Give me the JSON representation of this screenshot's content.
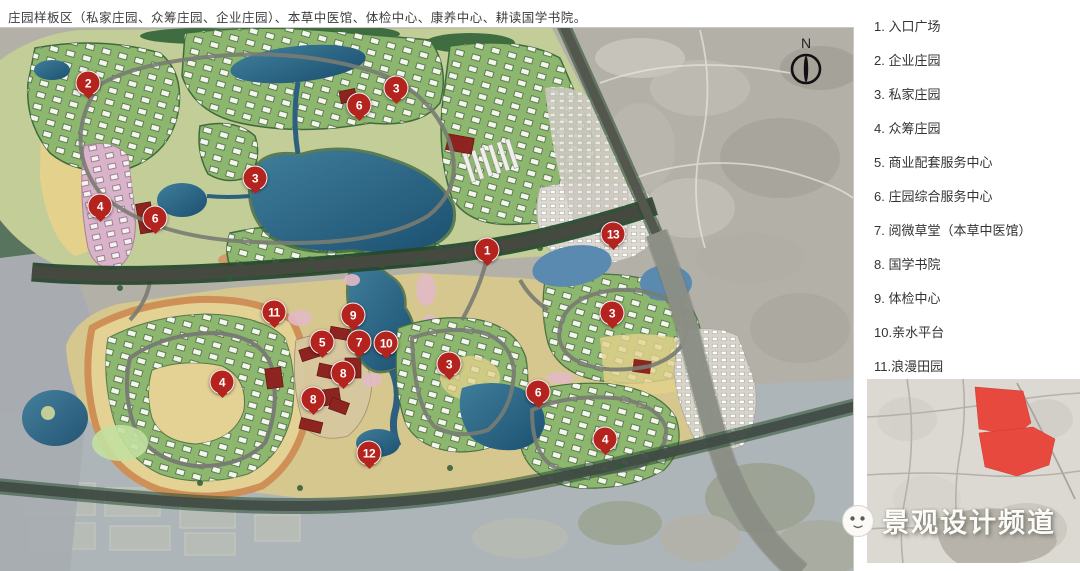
{
  "title": "庄园样板区（私家庄园、众筹庄园、企业庄园）、本草中医馆、体检中心、康养中心、耕读国学书院。",
  "legend": {
    "items": [
      {
        "num": "1",
        "label": "1. 入口广场"
      },
      {
        "num": "2",
        "label": "2. 企业庄园"
      },
      {
        "num": "3",
        "label": "3. 私家庄园"
      },
      {
        "num": "4",
        "label": "4. 众筹庄园"
      },
      {
        "num": "5",
        "label": "5. 商业配套服务中心"
      },
      {
        "num": "6",
        "label": "6. 庄园综合服务中心"
      },
      {
        "num": "7",
        "label": "7. 阅微草堂（本草中医馆）"
      },
      {
        "num": "8",
        "label": "8. 国学书院"
      },
      {
        "num": "9",
        "label": "9. 体检中心"
      },
      {
        "num": "10",
        "label": "10.亲水平台"
      },
      {
        "num": "11",
        "label": "11.浪漫田园"
      },
      {
        "num": "12",
        "label": "12.休憩平台"
      },
      {
        "num": "13",
        "label": "13.原有村庄"
      }
    ]
  },
  "map": {
    "north_label": "N",
    "markers": [
      {
        "label": "2",
        "x": 88,
        "y": 83
      },
      {
        "label": "3",
        "x": 396,
        "y": 88
      },
      {
        "label": "6",
        "x": 359,
        "y": 105
      },
      {
        "label": "3",
        "x": 255,
        "y": 178
      },
      {
        "label": "4",
        "x": 100,
        "y": 206
      },
      {
        "label": "6",
        "x": 155,
        "y": 218
      },
      {
        "label": "13",
        "x": 613,
        "y": 234
      },
      {
        "label": "1",
        "x": 487,
        "y": 250
      },
      {
        "label": "11",
        "x": 274,
        "y": 312
      },
      {
        "label": "9",
        "x": 353,
        "y": 315
      },
      {
        "label": "3",
        "x": 612,
        "y": 313
      },
      {
        "label": "5",
        "x": 322,
        "y": 342
      },
      {
        "label": "7",
        "x": 359,
        "y": 342
      },
      {
        "label": "10",
        "x": 386,
        "y": 343
      },
      {
        "label": "3",
        "x": 449,
        "y": 364
      },
      {
        "label": "8",
        "x": 343,
        "y": 373
      },
      {
        "label": "4",
        "x": 222,
        "y": 382
      },
      {
        "label": "6",
        "x": 538,
        "y": 392
      },
      {
        "label": "8",
        "x": 313,
        "y": 399
      },
      {
        "label": "4",
        "x": 605,
        "y": 439
      },
      {
        "label": "12",
        "x": 369,
        "y": 453
      }
    ]
  },
  "watermark": {
    "text": "景观设计频道",
    "icon": "wechat-face-icon"
  },
  "colors": {
    "marker_red": "#b5231f",
    "inset_highlight_red": "#e8493f",
    "water_deep": "#1d5070",
    "water_light": "#5b8ab0",
    "field_yellow": "#e4d28c",
    "orange_soil": "#d2945e",
    "forest_green": "#3e6a3e",
    "cluster_green": "#8db66e",
    "pink_area": "#d9b3c9",
    "road_dark": "#45493f",
    "satellite_gray": "#b3b0a8",
    "red_building": "#8e2420",
    "village_gray": "#dbd8d0"
  }
}
